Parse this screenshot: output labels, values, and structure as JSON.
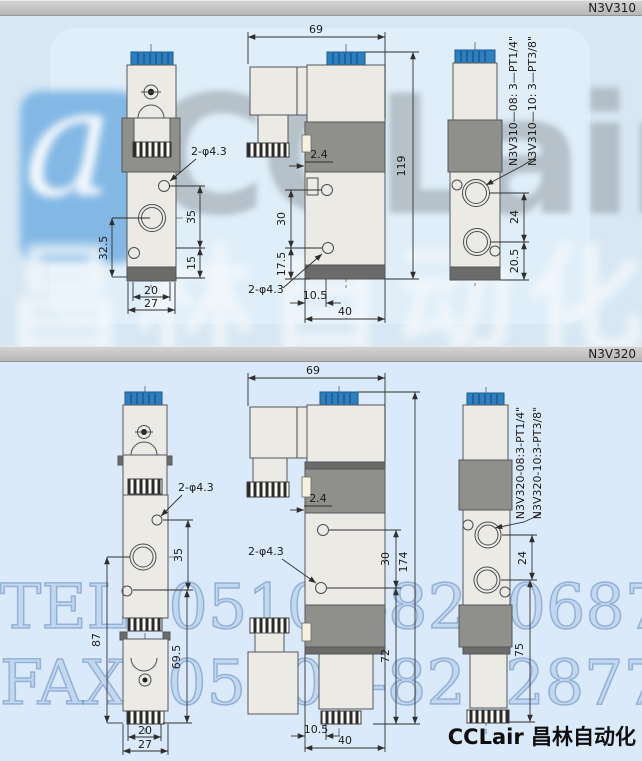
{
  "colors": {
    "header_bar": "#c4c4c4",
    "section1_bg": "#d7e7f3",
    "section2_bg": "#dbeafa",
    "cap_blue": "#2e7fc0",
    "body_light": "#eceae5",
    "coil_gray": "#8f8f8c",
    "dark_band": "#6b6b69",
    "watermark_logo_blue": "#83b8e5",
    "watermark_text_blue": "#a3c0e4",
    "brand_text": "#0e0e0e"
  },
  "section1": {
    "model": "N3V310",
    "front": {
      "hole_label": "2-φ4.3",
      "dim_35": "35",
      "dim_32_5": "32.5",
      "dim_15": "15",
      "dim_20": "20",
      "dim_27": "27"
    },
    "side": {
      "dim_69": "69",
      "dim_119": "119",
      "dim_2_4": "2.4",
      "dim_30": "30",
      "dim_17_5": "17.5",
      "hole_label": "2-φ4.3",
      "dim_10_5": "10.5",
      "dim_40": "40"
    },
    "right": {
      "dim_24": "24",
      "dim_20_5": "20.5",
      "thread1": "N3V310—08: 3—PT1/4\"",
      "thread2": "N3V310—10: 3—PT3/8\""
    },
    "watermark_logo_text": "CCLair",
    "watermark_swirl": "a",
    "watermark_cn": "昌林自动化"
  },
  "section2": {
    "model": "N3V320",
    "front": {
      "hole_label": "2-φ4.3",
      "dim_35": "35",
      "dim_87": "87",
      "dim_69_5": "69.5",
      "dim_20": "20",
      "dim_27": "27"
    },
    "side": {
      "dim_69": "69",
      "dim_174": "174",
      "dim_2_4": "2.4",
      "dim_30": "30",
      "hole_label": "2-φ4.3",
      "dim_72": "72",
      "dim_10_5": "10.5",
      "dim_40": "40"
    },
    "right": {
      "dim_24": "24",
      "dim_75": "75",
      "thread1": "N3V320-08:3-PT1/4\"",
      "thread2": "N3V320-10:3-PT3/8\""
    },
    "watermark_tel": "TEL: 0510—82306871",
    "watermark_fax": "FAX: 0510—82328771"
  },
  "footer": {
    "brand": "CCLair 昌林自动化"
  }
}
